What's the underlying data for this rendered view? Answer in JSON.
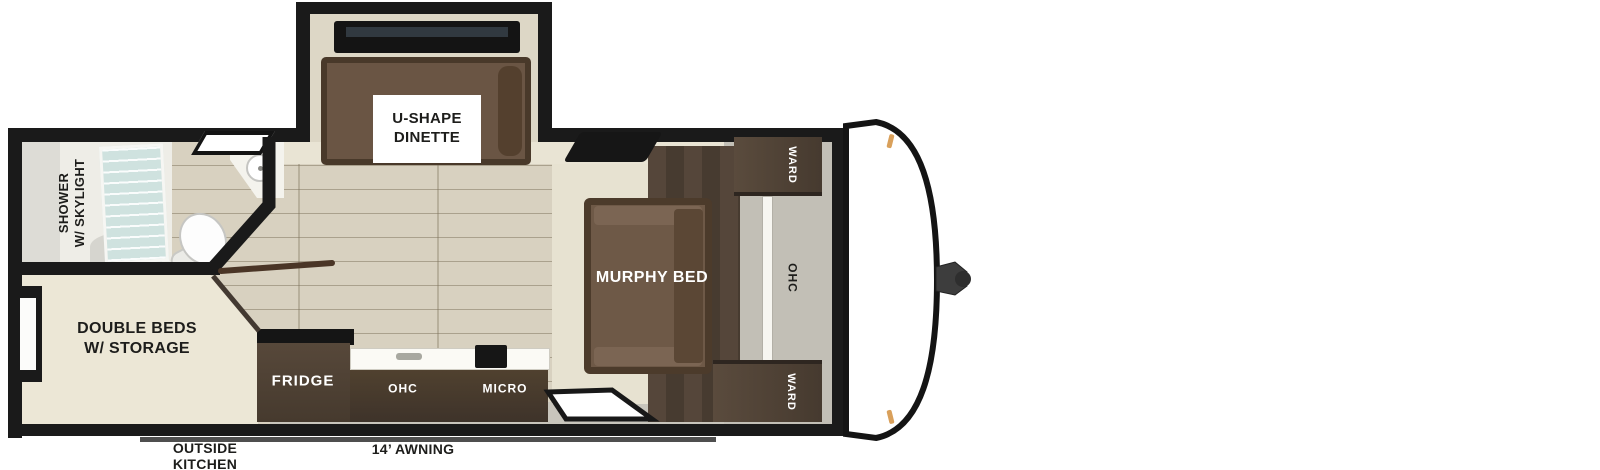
{
  "plan_type": "travel-trailer-floorplan",
  "rooms": {
    "dinette": {
      "label": "U-SHAPE\nDINETTE"
    },
    "bathroom": {
      "label": "SHOWER\nW/ SKYLIGHT"
    },
    "bedroom": {
      "label": "DOUBLE BEDS\nW/ STORAGE"
    },
    "living": {
      "murphy_bed_label": "MURPHY BED",
      "ward_top_label": "WARD",
      "ward_bottom_label": "WARD",
      "ohc_label": "OHC"
    },
    "kitchen": {
      "fridge_label": "FRIDGE",
      "ohc_label": "OHC",
      "micro_label": "MICRO"
    }
  },
  "exterior": {
    "outside_kitchen_label": "OUTSIDE\nKITCHEN",
    "awning_label": "14’ AWNING"
  },
  "colors": {
    "wall": "#1a1a1a",
    "cream-wall": "#e9e4d4",
    "wood": "#d8d1c0",
    "carpet": "#e7e2d1",
    "bed-cream": "#ece7d6",
    "walnut": "#4c3e33",
    "sofa": "#6e5947",
    "gray-front": "#c2bfb6",
    "label-dark": "#1d1d1b",
    "marker": "#d9a05b",
    "awning": "#4f4f4f",
    "glass": "#cfe2df"
  }
}
